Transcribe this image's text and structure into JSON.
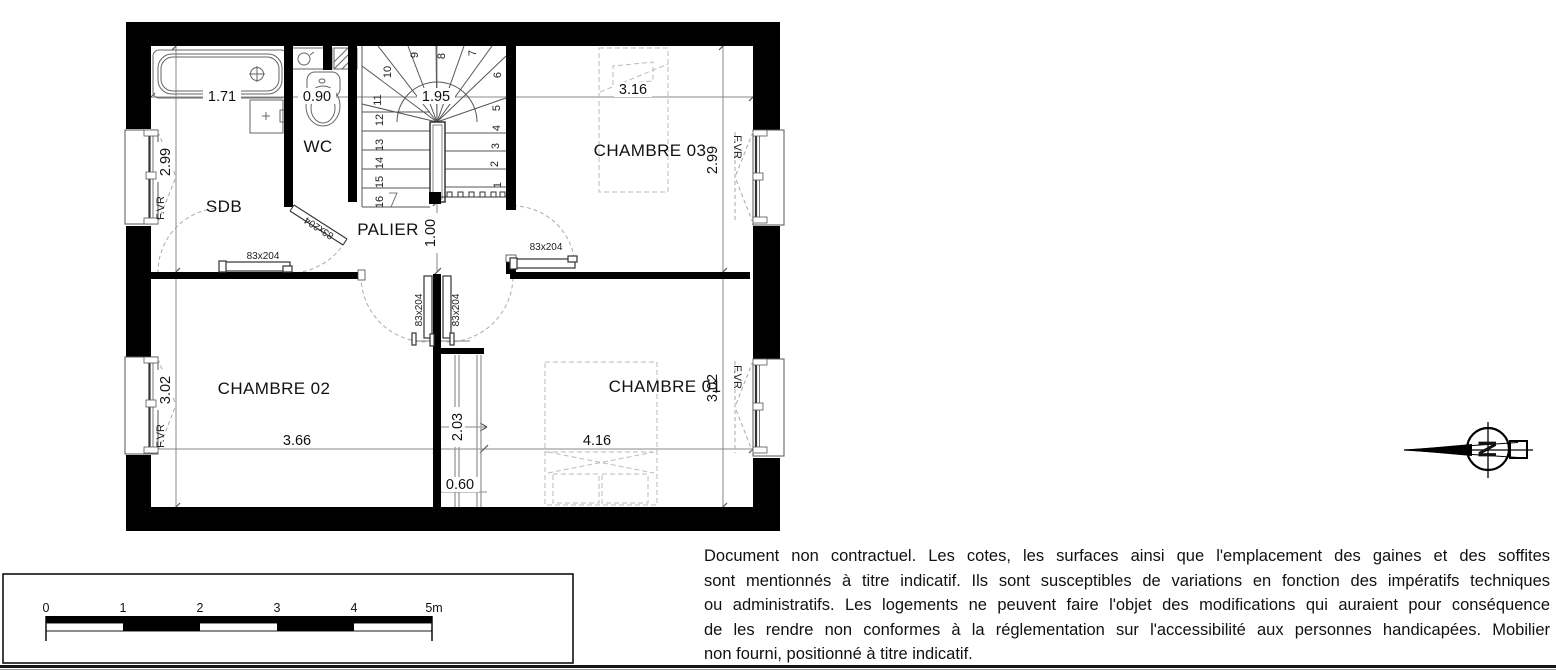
{
  "plan": {
    "rooms": {
      "sdb": "SDB",
      "wc": "WC",
      "palier": "PALIER",
      "ch03": "CHAMBRE 03",
      "ch02": "CHAMBRE 02",
      "ch01": "CHAMBRE 01"
    },
    "dims": {
      "bath": "1.71",
      "wc": "0.90",
      "stair": "1.95",
      "ch03": "3.16",
      "sdb_h": "2.99",
      "ch03_h": "2.99",
      "palier": "1.00",
      "ch02": "3.66",
      "ch01": "4.16",
      "ch02_h": "3.02",
      "ch01_h": "3.02",
      "closet": "2.03",
      "closet_w": "0.60"
    },
    "door_label": "83x204",
    "window_label": "F.VR",
    "steps": [
      "1",
      "2",
      "3",
      "4",
      "5",
      "6",
      "7",
      "8",
      "9",
      "10",
      "11",
      "12",
      "13",
      "14",
      "15",
      "16"
    ]
  },
  "scale_bar": {
    "ticks": [
      "0",
      "1",
      "2",
      "3",
      "4",
      "5m"
    ]
  },
  "compass": {
    "label": "N"
  },
  "colors": {
    "wall": "#000000",
    "dimension_line": "#888888",
    "furniture_dash": "#bbbbbb"
  },
  "disclaimer": {
    "lines": [
      "Document non contractuel. Les cotes, les surfaces ainsi que l'emplacement des gaines et des soffites",
      "sont mentionnés à titre indicatif. Ils sont susceptibles de variations en fonction des impératifs techniques",
      "ou administratifs. Les logements ne peuvent faire l'objet des modifications qui auraient pour conséquence",
      "de les rendre non conformes à la réglementation sur l'accessibilité aux personnes handicapées. Mobilier",
      "non fourni, positionné à titre indicatif."
    ]
  }
}
